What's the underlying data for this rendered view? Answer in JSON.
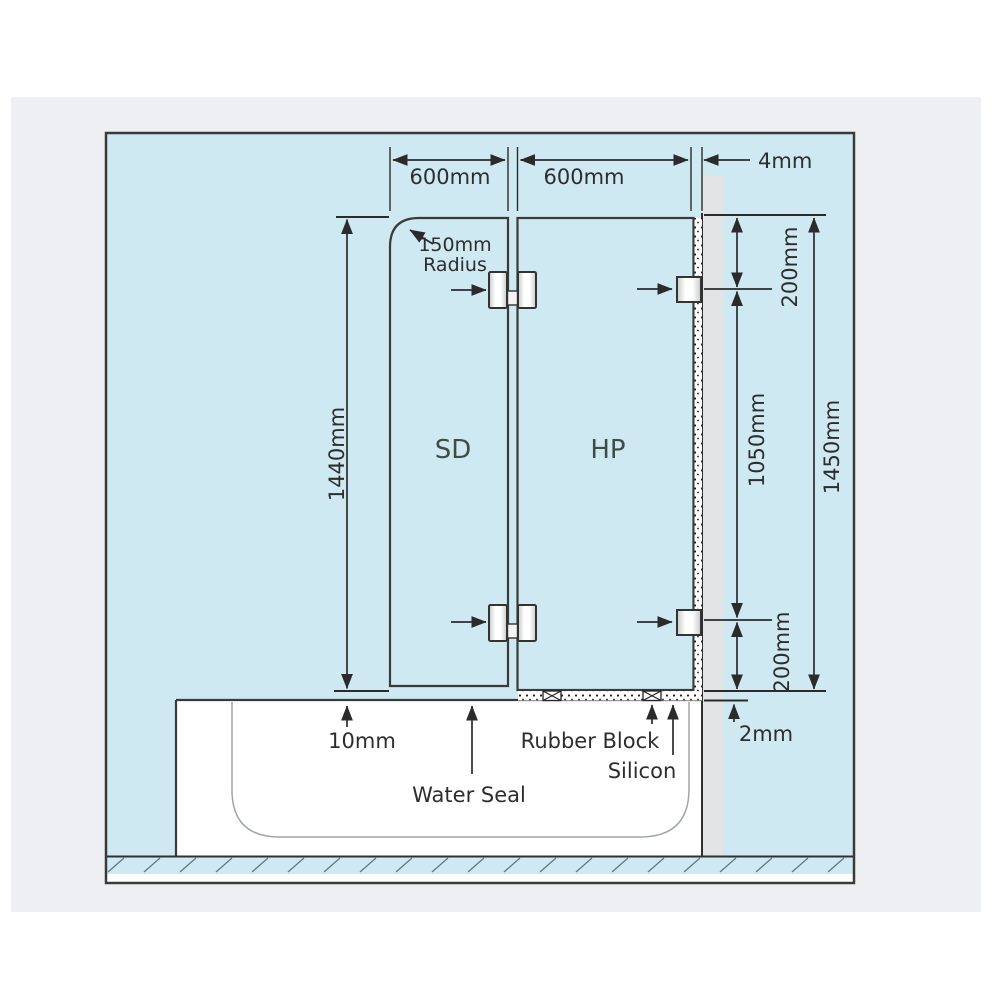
{
  "colors": {
    "canvas": "#cfe9f2",
    "photo_bg": "#edeff3",
    "wall": "#e2e4e5",
    "bath": "#ffffff",
    "glass_light": "#c3e3ca",
    "glass_mid": "#a3d2ae",
    "glass_dark": "#8fc49d",
    "line": "#2b2b2b"
  },
  "dimensions": {
    "sd_width": "600mm",
    "hp_width": "600mm",
    "wall_gap": "4mm",
    "radius_value": "150mm",
    "radius_word": "Radius",
    "sd_height": "1440mm",
    "top_offset": "200mm",
    "mid_span": "1050mm",
    "total_height": "1450mm",
    "bottom_offset": "200mm",
    "bath_gap": "10mm",
    "base_gap": "2mm"
  },
  "panels": {
    "shower_door": "SD",
    "hinge_panel": "HP"
  },
  "annotations": {
    "water_seal": "Water Seal",
    "rubber_block": "Rubber Block",
    "silicon": "Silicon"
  }
}
